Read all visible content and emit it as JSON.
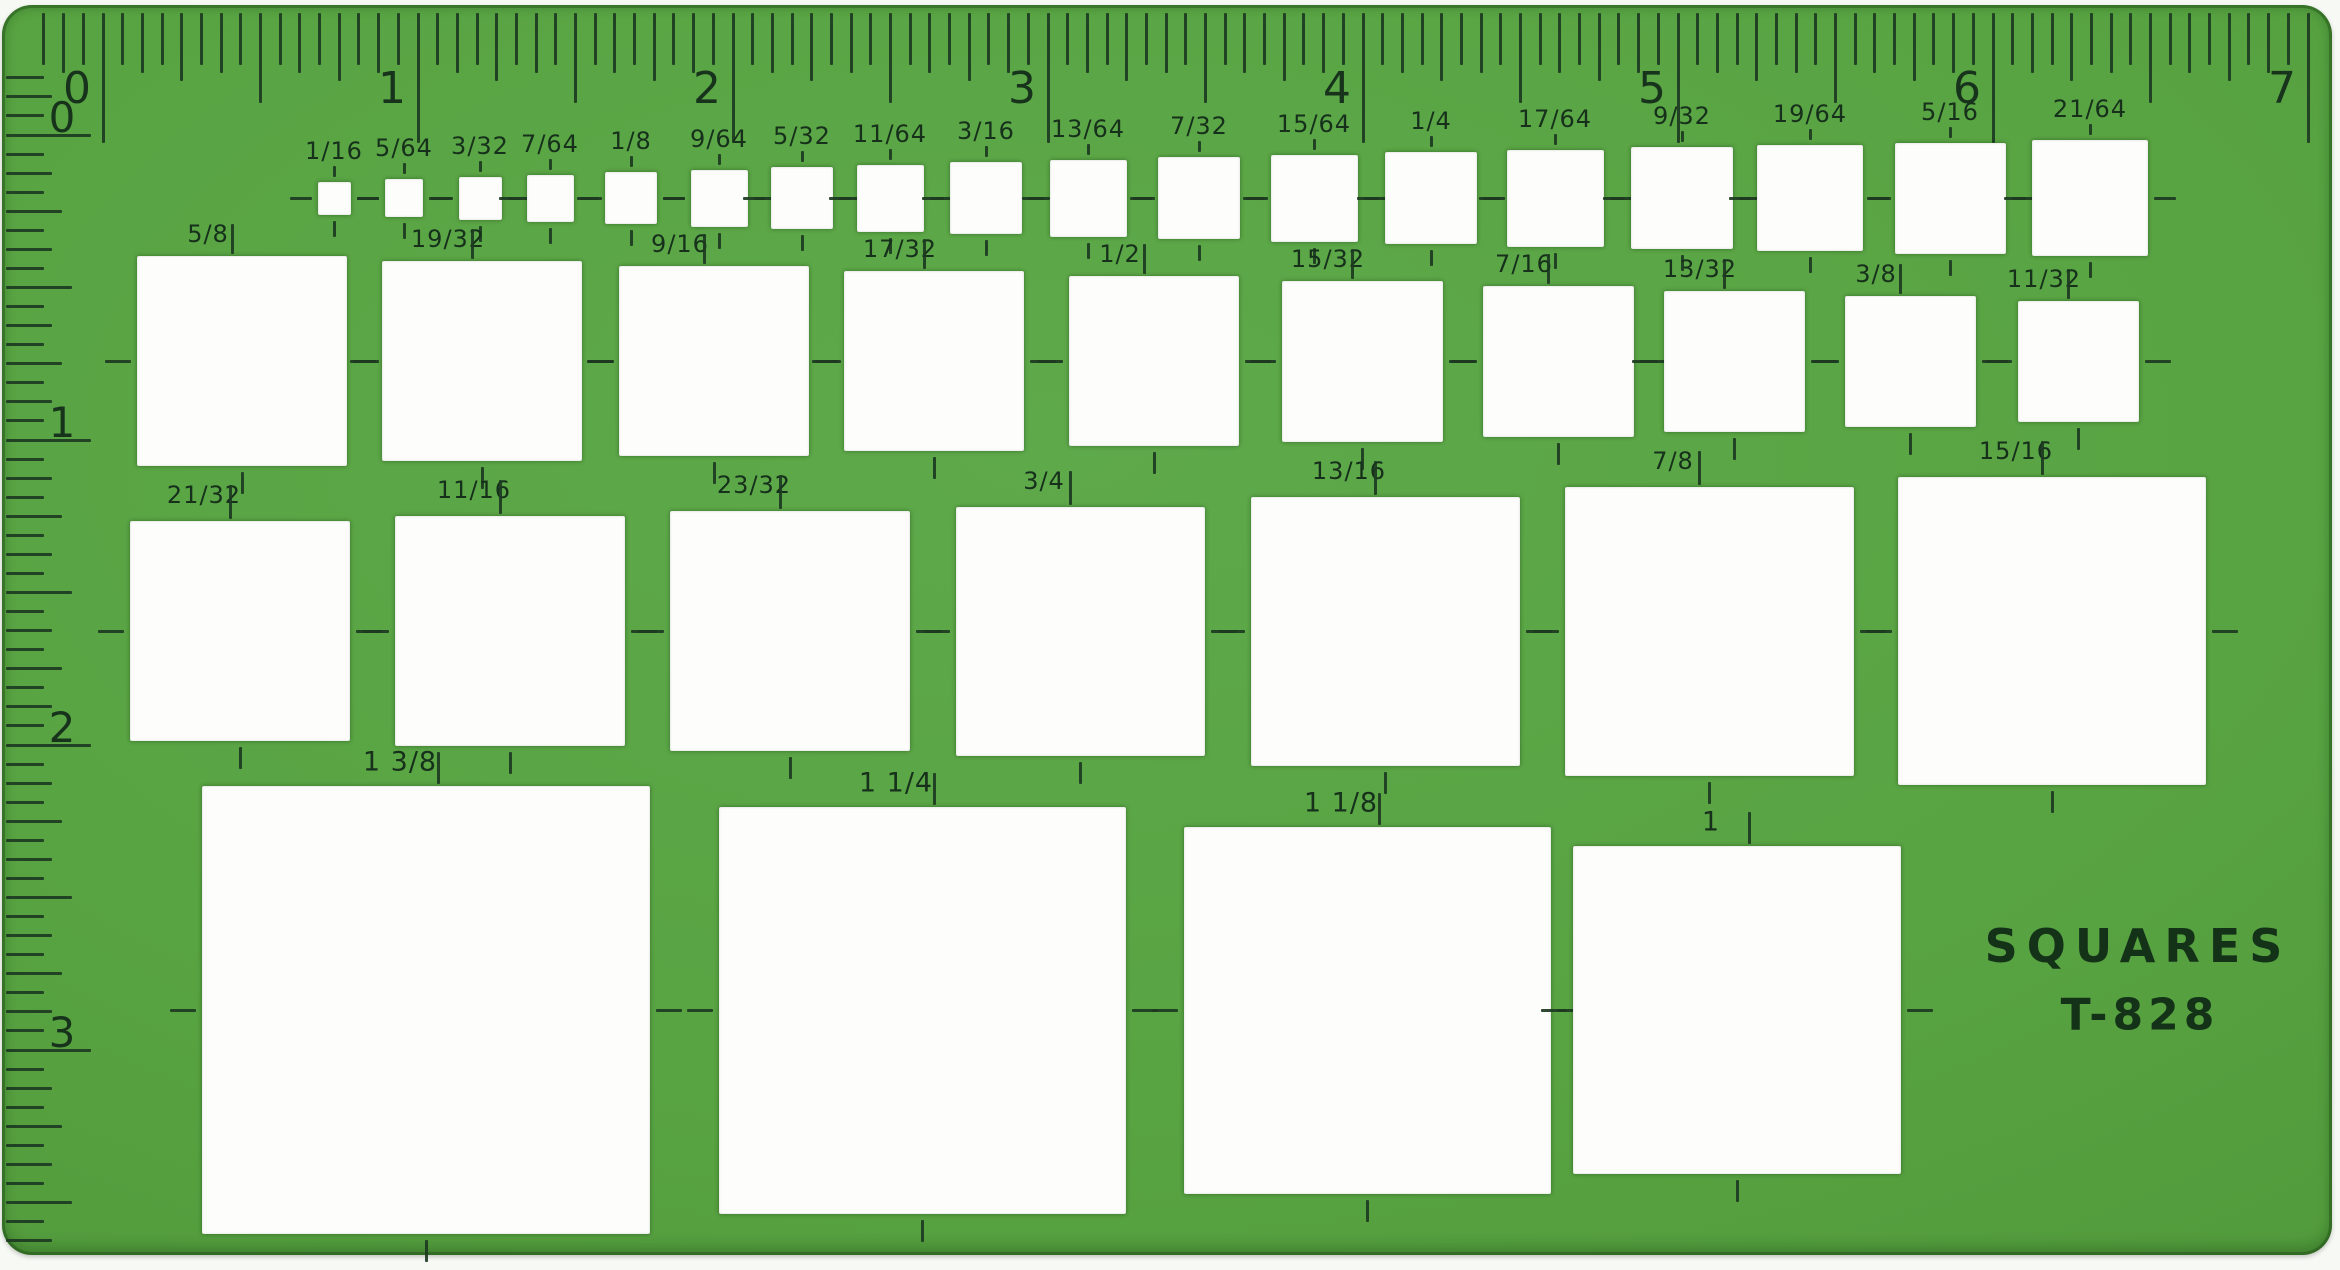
{
  "template": {
    "title": "SQUARES",
    "model": "T-828",
    "body_color": "#58a342",
    "ink_color": "#1d3a22",
    "cutout_color": "#fdfdfc"
  },
  "top_ruler": {
    "unit_numbers": [
      "0",
      "1",
      "2",
      "3",
      "4",
      "5",
      "6",
      "7"
    ]
  },
  "left_ruler": {
    "unit_numbers": [
      "0",
      "1",
      "2",
      "3"
    ]
  },
  "rows": [
    {
      "name": "row-1-small-squares",
      "labels": [
        "1/16",
        "5/64",
        "3/32",
        "7/64",
        "1/8",
        "9/64",
        "5/32",
        "11/64",
        "3/16",
        "13/64",
        "7/32",
        "15/64",
        "1/4",
        "17/64",
        "9/32",
        "19/64",
        "5/16",
        "21/64"
      ]
    },
    {
      "name": "row-2-squares",
      "labels": [
        "5/8",
        "19/32",
        "9/16",
        "17/32",
        "1/2",
        "15/32",
        "7/16",
        "13/32",
        "3/8",
        "11/32"
      ]
    },
    {
      "name": "row-3-squares",
      "labels": [
        "21/32",
        "11/16",
        "23/32",
        "3/4",
        "13/16",
        "7/8",
        "15/16"
      ]
    },
    {
      "name": "row-4-large-squares",
      "labels": [
        "1 3/8",
        "1 1/4",
        "1 1/8",
        "1"
      ]
    }
  ]
}
